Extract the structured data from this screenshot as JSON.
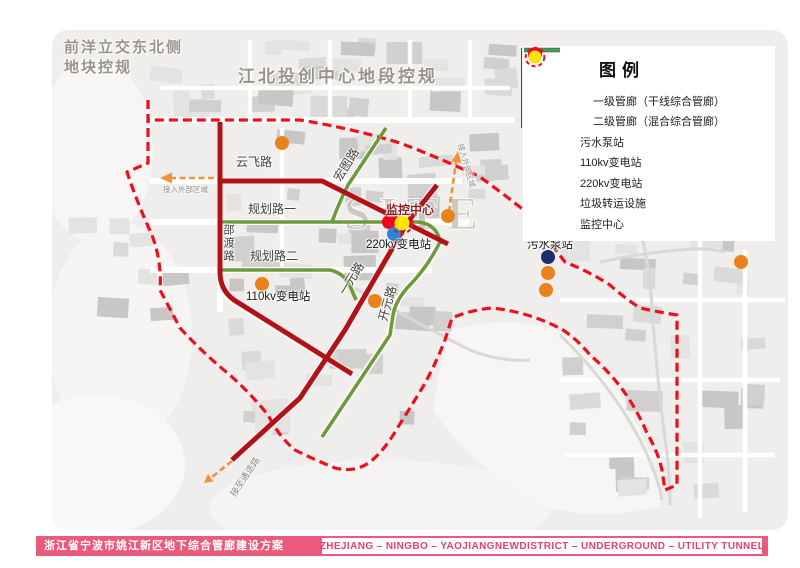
{
  "header_notes": {
    "northwest_plan_line1": "前洋立交东北侧",
    "northwest_plan_line2": "地块控规",
    "north_plan": "江北投创中心地段控规",
    "site_watermark": "SITE"
  },
  "roads": {
    "yunfei": "云飞路",
    "hongtu": "宏图路",
    "planning1": "规划路一",
    "planning2": "规划路二",
    "shaodu": "邵渡路",
    "yiyuan": "一元路",
    "kaiyuan": "开元路"
  },
  "facilities": {
    "monitoring_center": "监控中心",
    "substation_220kv": "220kv变电站",
    "substation_110kv": "110kv变电站",
    "sewage_pump": "污水泵站"
  },
  "connections": {
    "external_west": "接入外部区域",
    "external_north": "接入外部区域",
    "tongtu": "接至通途路"
  },
  "legend": {
    "title": "图例",
    "items": [
      {
        "label": "一级管廊（干线综合管廊）",
        "type": "line",
        "color": "#b01218"
      },
      {
        "label": "二级管廊（混合综合管廊）",
        "type": "line",
        "color": "#2fa566"
      },
      {
        "label": "污水泵站",
        "type": "dot",
        "color": "#1b2e6e"
      },
      {
        "label": "110kv变电站",
        "type": "dot",
        "color": "#e8821c"
      },
      {
        "label": "220kv变电站",
        "type": "dot",
        "color": "#2e85d5"
      },
      {
        "label": "垃圾转运设施",
        "type": "dot",
        "color": "#ea0b1e"
      },
      {
        "label": "监控中心",
        "type": "dot",
        "color": "#ffe400"
      }
    ]
  },
  "footer": {
    "title_cn": "浙江省宁波市姚江新区地下综合管廊建设方案",
    "title_en": "ZHEJIANG – NINGBO – YAOJIANGNEWDISTRICT – UNDERGROUND – UTILITY TUNNEL"
  },
  "colors": {
    "tunnel_primary": "#b01218",
    "tunnel_secondary": "#6f9a3a",
    "boundary": "#ec0f1e",
    "arrow_orange": "#f0913c",
    "dot_navy": "#1b2e6e",
    "dot_orange": "#e8821c",
    "dot_blue": "#2e85d5",
    "dot_red": "#ea0b1e",
    "dot_yellow": "#ffe400"
  }
}
